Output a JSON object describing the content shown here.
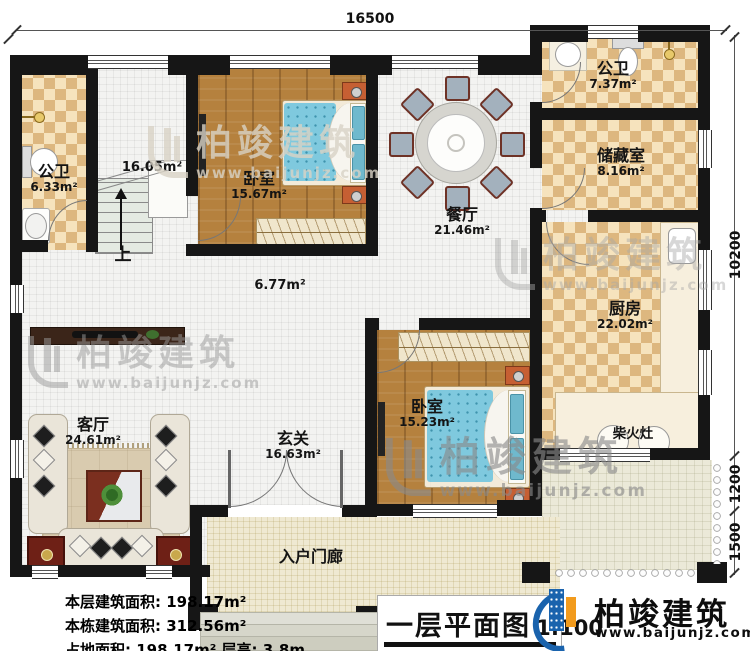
{
  "plan": {
    "title": "一层平面图",
    "scale": "1:100",
    "dimensions": {
      "top": "16500",
      "right_main": "10200",
      "right_mid": "1200",
      "right_low": "1500"
    },
    "rooms": [
      {
        "name": "公卫",
        "area": "6.33m²"
      },
      {
        "name": "公卫",
        "area": "7.37m²"
      },
      {
        "name": "储藏室",
        "area": "8.16m²"
      },
      {
        "name": "厨房",
        "area": "22.02m²"
      },
      {
        "name": "卧室",
        "area": "15.67m²"
      },
      {
        "name": "餐厅",
        "area": "21.46m²"
      },
      {
        "name": "卧室",
        "area": "15.23m²"
      },
      {
        "name": "客厅",
        "area": "24.61m²"
      },
      {
        "name": "玄关",
        "area": "16.63m²"
      },
      {
        "name": "入户门廊",
        "area": ""
      }
    ],
    "labels": {
      "stairs_area": "16.05m²",
      "hall_area": "6.77m²",
      "up": "上",
      "stove": "柴火灶"
    },
    "stats": [
      "本层建筑面积: 198.17m²",
      "本栋建筑面积: 312.56m²",
      "占地面积: 198.17m²  层高: 3.8m"
    ]
  },
  "brand": {
    "name": "柏竣建筑",
    "url": "www.baijunjz.com"
  },
  "colors": {
    "wall": "#161616",
    "checker": "#ddb77f",
    "wood": "#b5813e",
    "mattress": "#7fc9de",
    "brand_blue": "#1a63ad",
    "brand_orange": "#f29b1d"
  }
}
